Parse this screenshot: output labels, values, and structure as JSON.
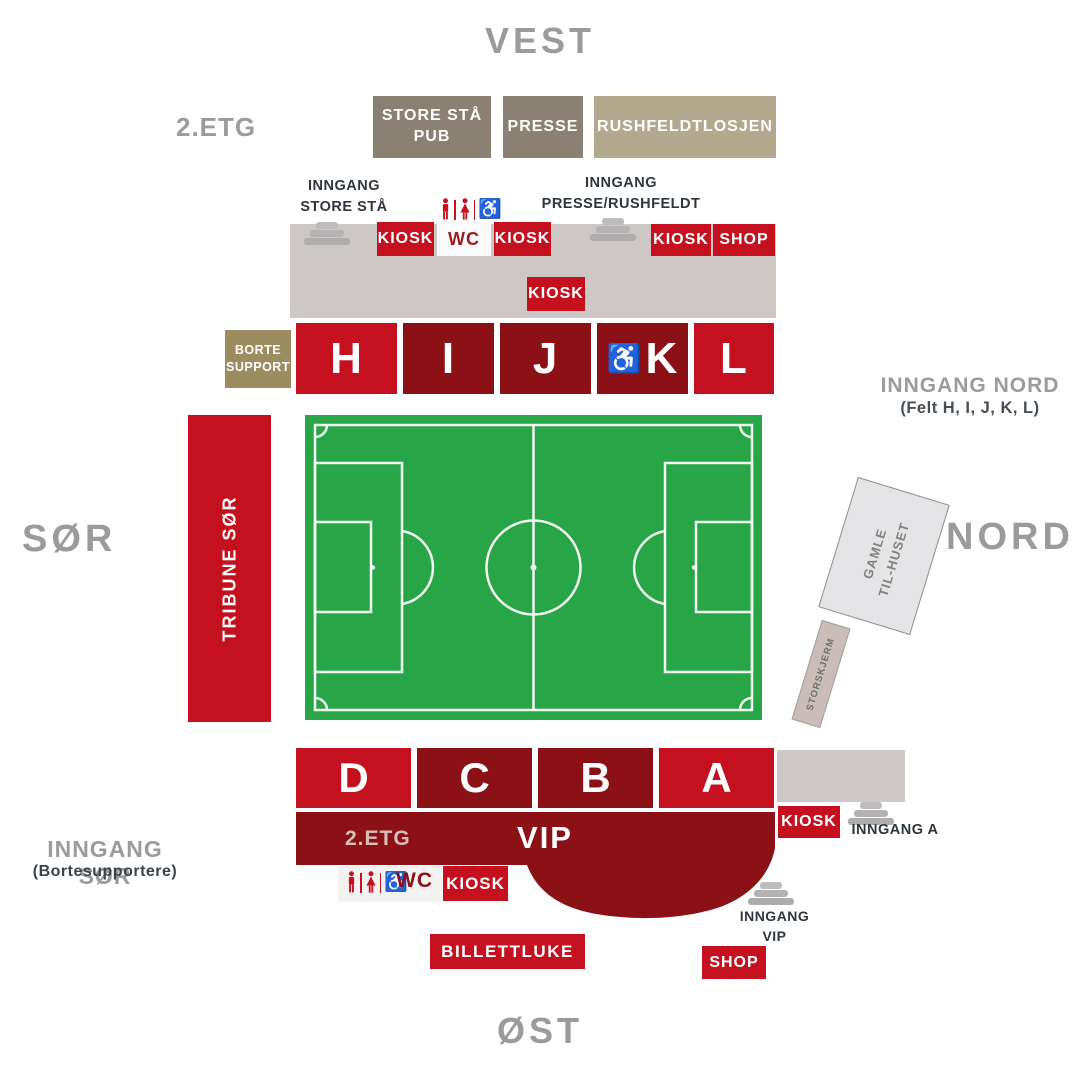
{
  "compass": {
    "west": "VEST",
    "east": "ØST",
    "south": "SØR",
    "north": "NORD"
  },
  "labels": {
    "kiosk": "KIOSK",
    "wc": "WC",
    "shop": "SHOP",
    "vip": "VIP",
    "etg2": "2.ETG",
    "billettluke": "BILLETTLUKE"
  },
  "west_upper": {
    "floor": "2.ETG",
    "boxes": [
      {
        "label": "STORE STÅ\nPUB"
      },
      {
        "label": "PRESSE"
      },
      {
        "label": "RUSHFELDTLOSJEN"
      }
    ]
  },
  "entrances": {
    "store_staa": "INNGANG\nSTORE STÅ",
    "presse": "INNGANG\nPRESSE/RUSHFELDT",
    "nord_title": "INNGANG NORD",
    "nord_sub": "(Felt H, I, J, K, L)",
    "a": "INNGANG A",
    "vip": "INNGANG\nVIP",
    "sor_title": "INNGANG SØR",
    "sor_sub": "(Bortesupportere)"
  },
  "stands": {
    "tribune_sor": "TRIBUNE SØR",
    "borte_support": "BORTE\nSUPPORT",
    "north": [
      {
        "label": "H",
        "tone": "bright"
      },
      {
        "label": "I",
        "tone": "dark"
      },
      {
        "label": "J",
        "tone": "dark"
      },
      {
        "label": "K",
        "tone": "dark",
        "wheelchair": true
      },
      {
        "label": "L",
        "tone": "bright"
      }
    ],
    "south": [
      {
        "label": "D",
        "tone": "bright"
      },
      {
        "label": "C",
        "tone": "dark"
      },
      {
        "label": "B",
        "tone": "dark"
      },
      {
        "label": "A",
        "tone": "bright"
      }
    ]
  },
  "buildings": {
    "gamle": "GAMLE\nTIL-HUSET",
    "storskjerm": "STORSKJERM"
  },
  "icons": {
    "wheelchair_glyph": "♿",
    "stairs": "stairs-icon",
    "restroom": "man-woman-wheelchair-icons"
  },
  "colors": {
    "bright_red": "#c5101f",
    "dark_red": "#8c1117",
    "olive": "#8a8173",
    "tan": "#b3a98e",
    "borte_olive": "#9d8c60",
    "concourse_gray": "#cdc7c5",
    "pitch_green": "#28a546",
    "gray_text": "#9b9b9b",
    "dark_text": "#2f363d"
  }
}
